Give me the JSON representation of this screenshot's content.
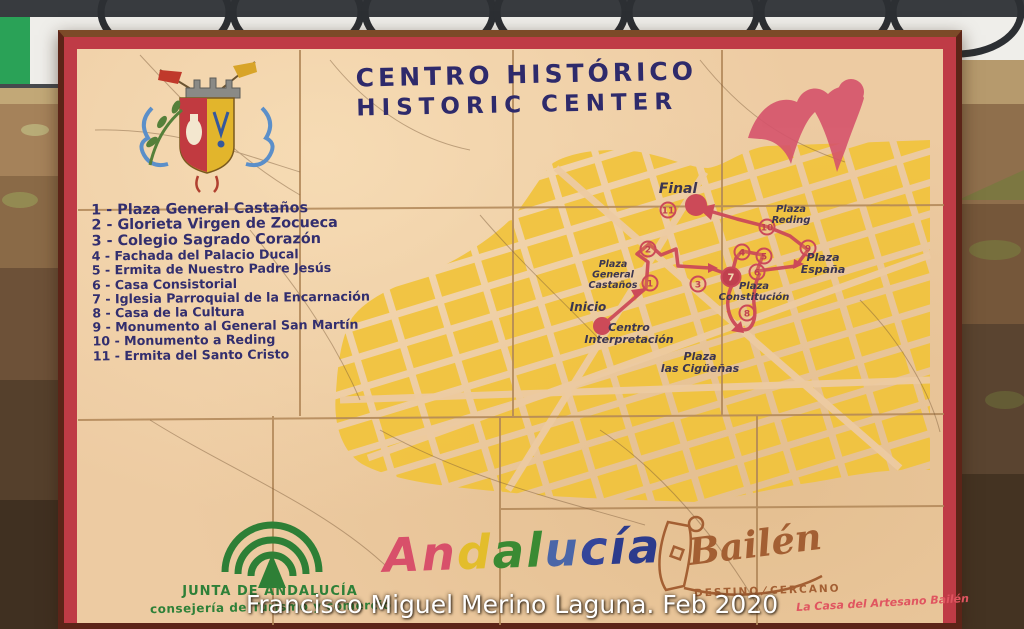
{
  "photo": {
    "caption": "Francisco Miguel Merino Laguna. Feb 2020",
    "scene": "ceramic tile tourist map panel mounted on a stone wall behind a wrought-iron railing"
  },
  "sign": {
    "title": {
      "line1": "CENTRO HISTÓRICO",
      "line2": "HISTORIC CENTER"
    },
    "legend": {
      "items": [
        {
          "num": "1",
          "name": "Plaza General Castaños"
        },
        {
          "num": "2",
          "name": "Glorieta Virgen de Zocueca"
        },
        {
          "num": "3",
          "name": "Colegio Sagrado Corazón"
        },
        {
          "num": "4",
          "name": "Fachada del Palacio Ducal"
        },
        {
          "num": "5",
          "name": "Ermita de Nuestro Padre Jesús"
        },
        {
          "num": "6",
          "name": "Casa Consistorial"
        },
        {
          "num": "7",
          "name": "Iglesia Parroquial de la Encarnación"
        },
        {
          "num": "8",
          "name": "Casa de la Cultura"
        },
        {
          "num": "9",
          "name": "Monumento al General San Martín"
        },
        {
          "num": "10",
          "name": "Monumento a Reding"
        },
        {
          "num": "11",
          "name": "Ermita del Santo Cristo"
        }
      ]
    },
    "map": {
      "markers": [
        {
          "n": "1",
          "x": 650,
          "y": 283
        },
        {
          "n": "2",
          "x": 648,
          "y": 249
        },
        {
          "n": "3",
          "x": 698,
          "y": 284
        },
        {
          "n": "4",
          "x": 742,
          "y": 252
        },
        {
          "n": "5",
          "x": 764,
          "y": 256
        },
        {
          "n": "6",
          "x": 757,
          "y": 272
        },
        {
          "n": "7",
          "x": 731,
          "y": 277,
          "big": true
        },
        {
          "n": "8",
          "x": 747,
          "y": 313
        },
        {
          "n": "9",
          "x": 808,
          "y": 248
        },
        {
          "n": "10",
          "x": 767,
          "y": 227
        },
        {
          "n": "11",
          "x": 668,
          "y": 210
        }
      ],
      "labels": [
        {
          "lines": [
            "Final"
          ],
          "x": 678,
          "y": 193,
          "size": 14,
          "bold": true
        },
        {
          "lines": [
            "Plaza",
            "Reding"
          ],
          "x": 791,
          "y": 212,
          "size": 10
        },
        {
          "lines": [
            "Plaza",
            "España"
          ],
          "x": 823,
          "y": 261,
          "size": 11
        },
        {
          "lines": [
            "Plaza",
            "Constitución"
          ],
          "x": 754,
          "y": 289,
          "size": 10
        },
        {
          "lines": [
            "Plaza",
            "General",
            "Castaños"
          ],
          "x": 613,
          "y": 267,
          "size": 9.5
        },
        {
          "lines": [
            "Inicio"
          ],
          "x": 588,
          "y": 311,
          "size": 12,
          "bold": true
        },
        {
          "lines": [
            "Centro",
            "Interpretación"
          ],
          "x": 629,
          "y": 331,
          "size": 11
        },
        {
          "lines": [
            "Plaza",
            "las Cigüeñas"
          ],
          "x": 700,
          "y": 360,
          "size": 11
        }
      ]
    },
    "footer": {
      "junta_line1": "JUNTA DE ANDALUCÍA",
      "junta_line2": "consejería de Turismo y comercio",
      "andalucia_letters": [
        {
          "ch": "A",
          "color": "#d8506a"
        },
        {
          "ch": "n",
          "color": "#d8506a"
        },
        {
          "ch": "d",
          "color": "#e3bd2b"
        },
        {
          "ch": "a",
          "color": "#3a8a33"
        },
        {
          "ch": "l",
          "color": "#3a8a33"
        },
        {
          "ch": "u",
          "color": "#4a66a8"
        },
        {
          "ch": "c",
          "color": "#34459a"
        },
        {
          "ch": "í",
          "color": "#2c3b8c"
        },
        {
          "ch": "a",
          "color": "#2c3b8c"
        }
      ],
      "bailen_script": "Bailén",
      "bailen_sub1": "DESTINO",
      "bailen_slash": "/",
      "bailen_sub2": "CERCANO",
      "artesano": "La Casa del Artesano Bailén"
    },
    "colors": {
      "tile_cream": "#edcba2",
      "frame_red": "#bf3b46",
      "frame_wood": "#5c2418",
      "map_yellow": "#f1c33b",
      "route_red": "#cc4a58",
      "text_navy": "#2e2a6b",
      "junta_green": "#2e8038",
      "bailen_brown": "#a35f33",
      "artesano_red": "#e05560",
      "label_ink": "#3b3550"
    }
  }
}
